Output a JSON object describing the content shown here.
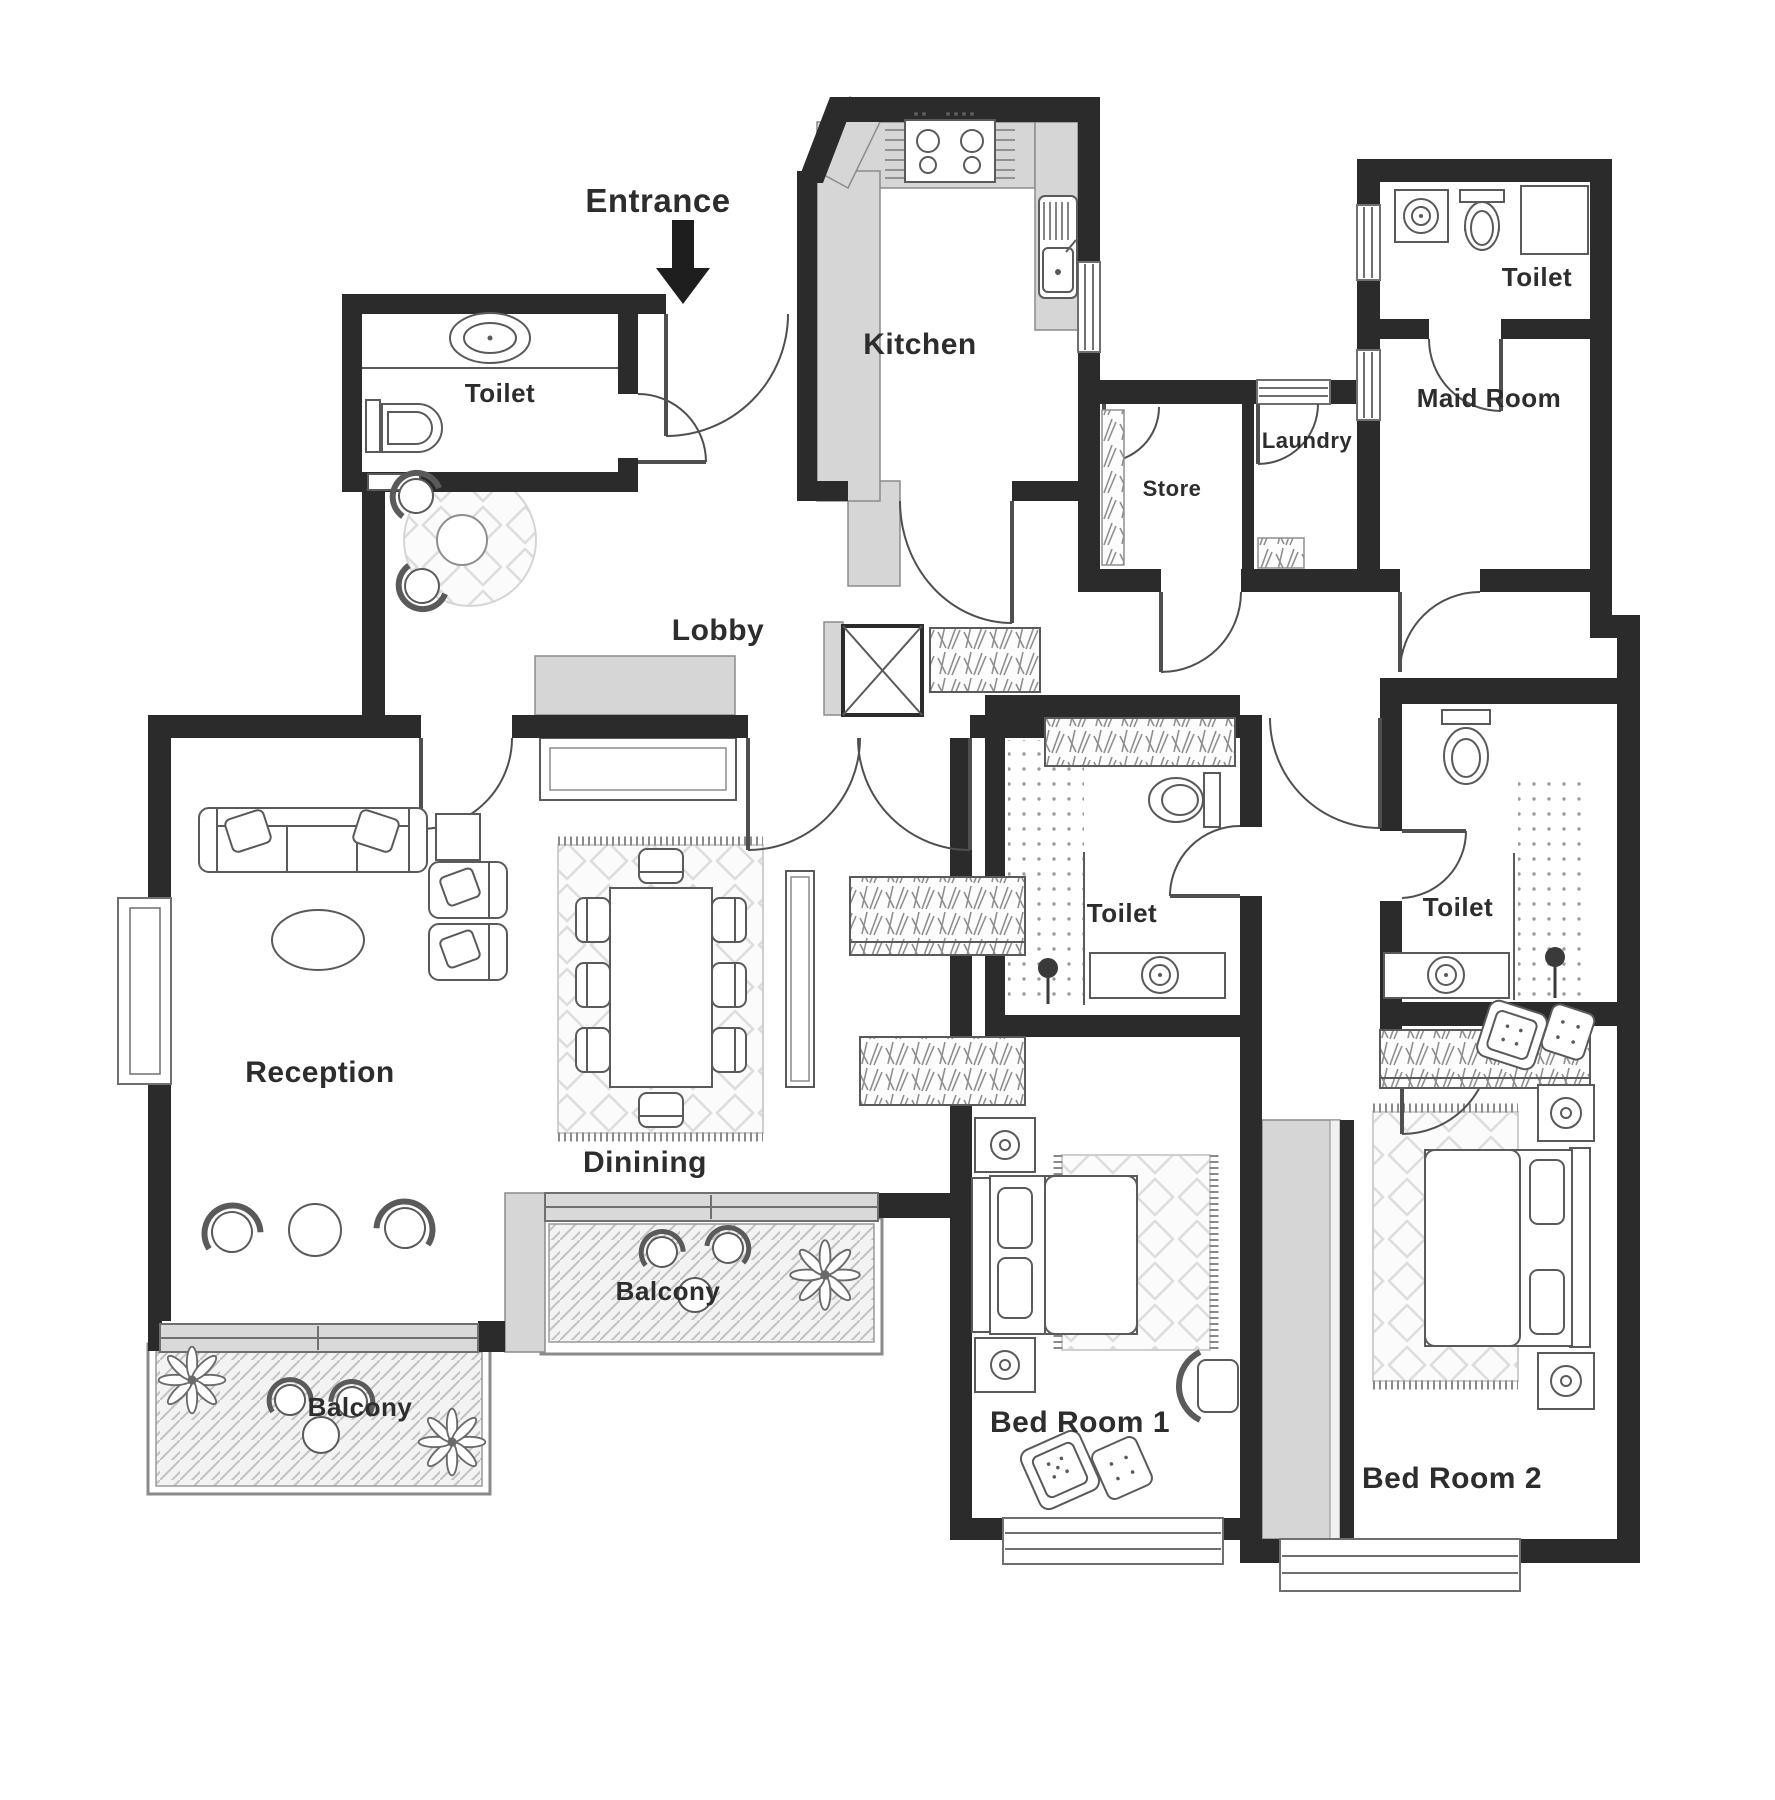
{
  "plan": {
    "type": "apartment-floor-plan",
    "colors": {
      "wall": "#2b2b2b",
      "counter_gray": "#d6d6d6",
      "floor": "#ffffff",
      "label_text": "#2d2d2d"
    }
  },
  "annotations": {
    "entrance": {
      "label": "Entrance"
    }
  },
  "rooms": {
    "toilet_guest": {
      "label": "Toilet"
    },
    "kitchen": {
      "label": "Kitchen"
    },
    "lobby": {
      "label": "Lobby"
    },
    "toilet_maid": {
      "label": "Toilet"
    },
    "maid_room": {
      "label": "Maid Room"
    },
    "laundry": {
      "label": "Laundry"
    },
    "store": {
      "label": "Store"
    },
    "reception": {
      "label": "Reception"
    },
    "dining": {
      "label": "Dinining"
    },
    "toilet_bedroom1": {
      "label": "Toilet"
    },
    "toilet_bedroom2": {
      "label": "Toilet"
    },
    "bedroom1": {
      "label": "Bed Room 1"
    },
    "bedroom2": {
      "label": "Bed Room 2"
    },
    "balcony_reception": {
      "label": "Balcony"
    },
    "balcony_dining": {
      "label": "Balcony"
    }
  }
}
